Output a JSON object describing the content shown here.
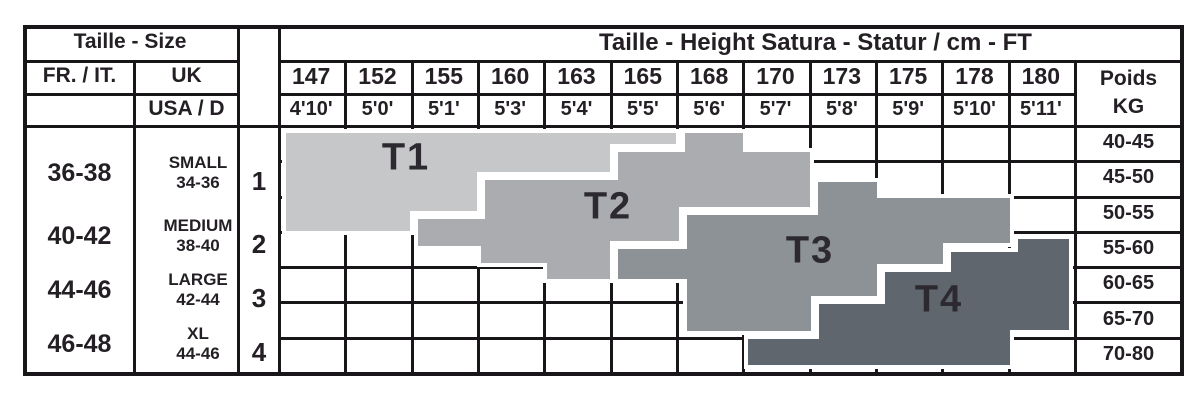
{
  "page": {
    "background": "#ffffff",
    "line_color": "#19161a",
    "text_color": "#231f24"
  },
  "header": {
    "size_title": "Taille - Size",
    "height_title": "Taille - Height Satura - Statur / cm - FT",
    "fr_it": "FR. / IT.",
    "uk": "UK",
    "usa_d": "USA / D",
    "poids_line1": "Poids",
    "poids_line2": "KG"
  },
  "heights_cm": [
    "147",
    "152",
    "155",
    "160",
    "163",
    "165",
    "168",
    "170",
    "173",
    "175",
    "178",
    "180"
  ],
  "heights_ft": [
    "4'10'",
    "5'0'",
    "5'1'",
    "5'3'",
    "5'4'",
    "5'5'",
    "5'6'",
    "5'7'",
    "5'8'",
    "5'9'",
    "5'10'",
    "5'11'"
  ],
  "weights_kg": [
    "40-45",
    "45-50",
    "50-55",
    "55-60",
    "60-65",
    "65-70",
    "70-80"
  ],
  "sizes": [
    {
      "fr_it": "36-38",
      "uk": "SMALL",
      "usa_d": "34-36",
      "index": "1"
    },
    {
      "fr_it": "40-42",
      "uk": "MEDIUM",
      "usa_d": "38-40",
      "index": "2"
    },
    {
      "fr_it": "44-46",
      "uk": "LARGE",
      "usa_d": "42-44",
      "index": "3"
    },
    {
      "fr_it": "46-48",
      "uk": "XL",
      "usa_d": "44-46",
      "index": "4"
    }
  ],
  "bands": [
    {
      "label": "T1",
      "color": "#c6c7c9",
      "points": "284,131 678,131 678,146 612,146 612,174 479,174 479,213 412,213 412,233 284,233",
      "label_x": 406,
      "label_y": 158
    },
    {
      "label": "T2",
      "color": "#aaacaf",
      "points": "683,131 745,131 745,150 812,150 812,209 681,209 681,243 612,243 612,281 545,281 545,265 479,265 479,248 416,248 416,217 483,217 483,178 616,178 616,150 683,150",
      "label_x": 608,
      "label_y": 207
    },
    {
      "label": "T3",
      "color": "#8d9296",
      "points": "616,247 685,247 685,213 816,213 816,180 879,180 879,196 1012,196 1012,245 945,245 945,266 879,266 879,298 813,298 813,333 685,333 685,281 616,281",
      "label_x": 810,
      "label_y": 251
    },
    {
      "label": "T4",
      "color": "#5f666d",
      "points": "1016,237 1071,237 1071,332 1012,332 1012,367 746,367 746,337 817,337 817,302 883,302 883,270 949,270 949,250 1016,250",
      "label_x": 939,
      "label_y": 300
    }
  ],
  "chart_data": {
    "type": "table",
    "title": "Taille - Height Satura - Statur / cm - FT",
    "xlabel": "Height (cm / ft)",
    "ylabel": "Poids KG",
    "columns_height_cm": [
      147,
      152,
      155,
      160,
      163,
      165,
      168,
      170,
      173,
      175,
      178,
      180
    ],
    "columns_height_ft": [
      "4'10'",
      "5'0'",
      "5'1'",
      "5'3'",
      "5'4'",
      "5'5'",
      "5'6'",
      "5'7'",
      "5'8'",
      "5'9'",
      "5'10'",
      "5'11'"
    ],
    "rows_weight_kg": [
      "40-45",
      "45-50",
      "50-55",
      "55-60",
      "60-65",
      "65-70",
      "70-80"
    ],
    "size_bands": [
      {
        "code": "T1",
        "fr_it": "36-38",
        "uk": "SMALL",
        "usa_d": "34-36",
        "index": 1,
        "coverage": [
          {
            "cm": 147,
            "kg": "40-55"
          },
          {
            "cm": 152,
            "kg": "40-55"
          },
          {
            "cm": 155,
            "kg": "40-52"
          },
          {
            "cm": 160,
            "kg": "40-46"
          },
          {
            "cm": 163,
            "kg": "40-46"
          },
          {
            "cm": 165,
            "kg": "40-42"
          }
        ]
      },
      {
        "code": "T2",
        "fr_it": "40-42",
        "uk": "MEDIUM",
        "usa_d": "38-40",
        "index": 2,
        "coverage": [
          {
            "cm": 155,
            "kg": "53-57"
          },
          {
            "cm": 160,
            "kg": "47-60"
          },
          {
            "cm": 163,
            "kg": "47-62"
          },
          {
            "cm": 165,
            "kg": "43-56"
          },
          {
            "cm": 168,
            "kg": "40-52"
          },
          {
            "cm": 170,
            "kg": "43-52"
          }
        ]
      },
      {
        "code": "T3",
        "fr_it": "44-46",
        "uk": "LARGE",
        "usa_d": "42-44",
        "index": 3,
        "coverage": [
          {
            "cm": 165,
            "kg": "57-62"
          },
          {
            "cm": 168,
            "kg": "52-69"
          },
          {
            "cm": 170,
            "kg": "52-69"
          },
          {
            "cm": 173,
            "kg": "47-64"
          },
          {
            "cm": 175,
            "kg": "50-60"
          },
          {
            "cm": 178,
            "kg": "50-57"
          }
        ]
      },
      {
        "code": "T4",
        "fr_it": "46-48",
        "uk": "XL",
        "usa_d": "44-46",
        "index": 4,
        "coverage": [
          {
            "cm": 170,
            "kg": "70-79"
          },
          {
            "cm": 173,
            "kg": "65-79"
          },
          {
            "cm": 175,
            "kg": "60-79"
          },
          {
            "cm": 178,
            "kg": "57-79"
          },
          {
            "cm": 180,
            "kg": "55-69"
          }
        ]
      }
    ]
  }
}
